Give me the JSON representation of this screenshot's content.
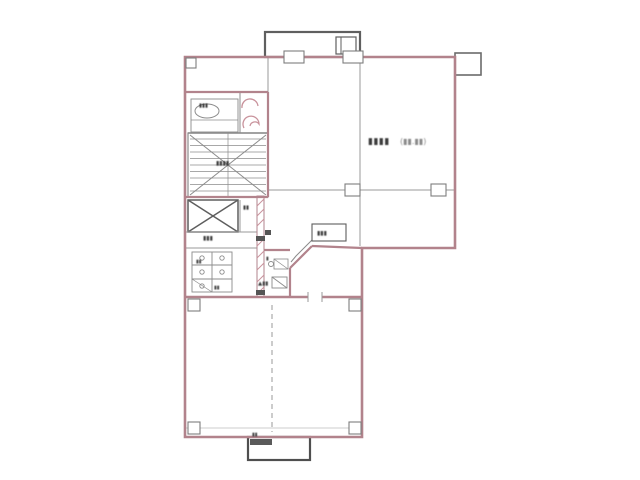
{
  "document": {
    "type": "building-floor-plan",
    "background": "#ffffff"
  },
  "colors": {
    "wall": "#b2838c",
    "wall_hatch": "#c9939c",
    "thin_line": "#9a9a9a",
    "dark_line": "#555555",
    "label_text": "#3a3a3a",
    "label_text_light": "#8a8a8a"
  },
  "labels": {
    "main_room_name": "▮▮▮▮",
    "main_room_area": "(▮▮.▮▮)",
    "machine_room": "▮▮▮",
    "stairs": "▮▮▮▮",
    "shaft_top": "▮▮",
    "ev_hall": "▮▮▮",
    "washroom_a": "▮▮",
    "washroom_b": "▮▮",
    "kitchen_side": "▮",
    "kitchen": "▲▮▮",
    "callout": "▮▮▮",
    "porch": "▮▮"
  }
}
